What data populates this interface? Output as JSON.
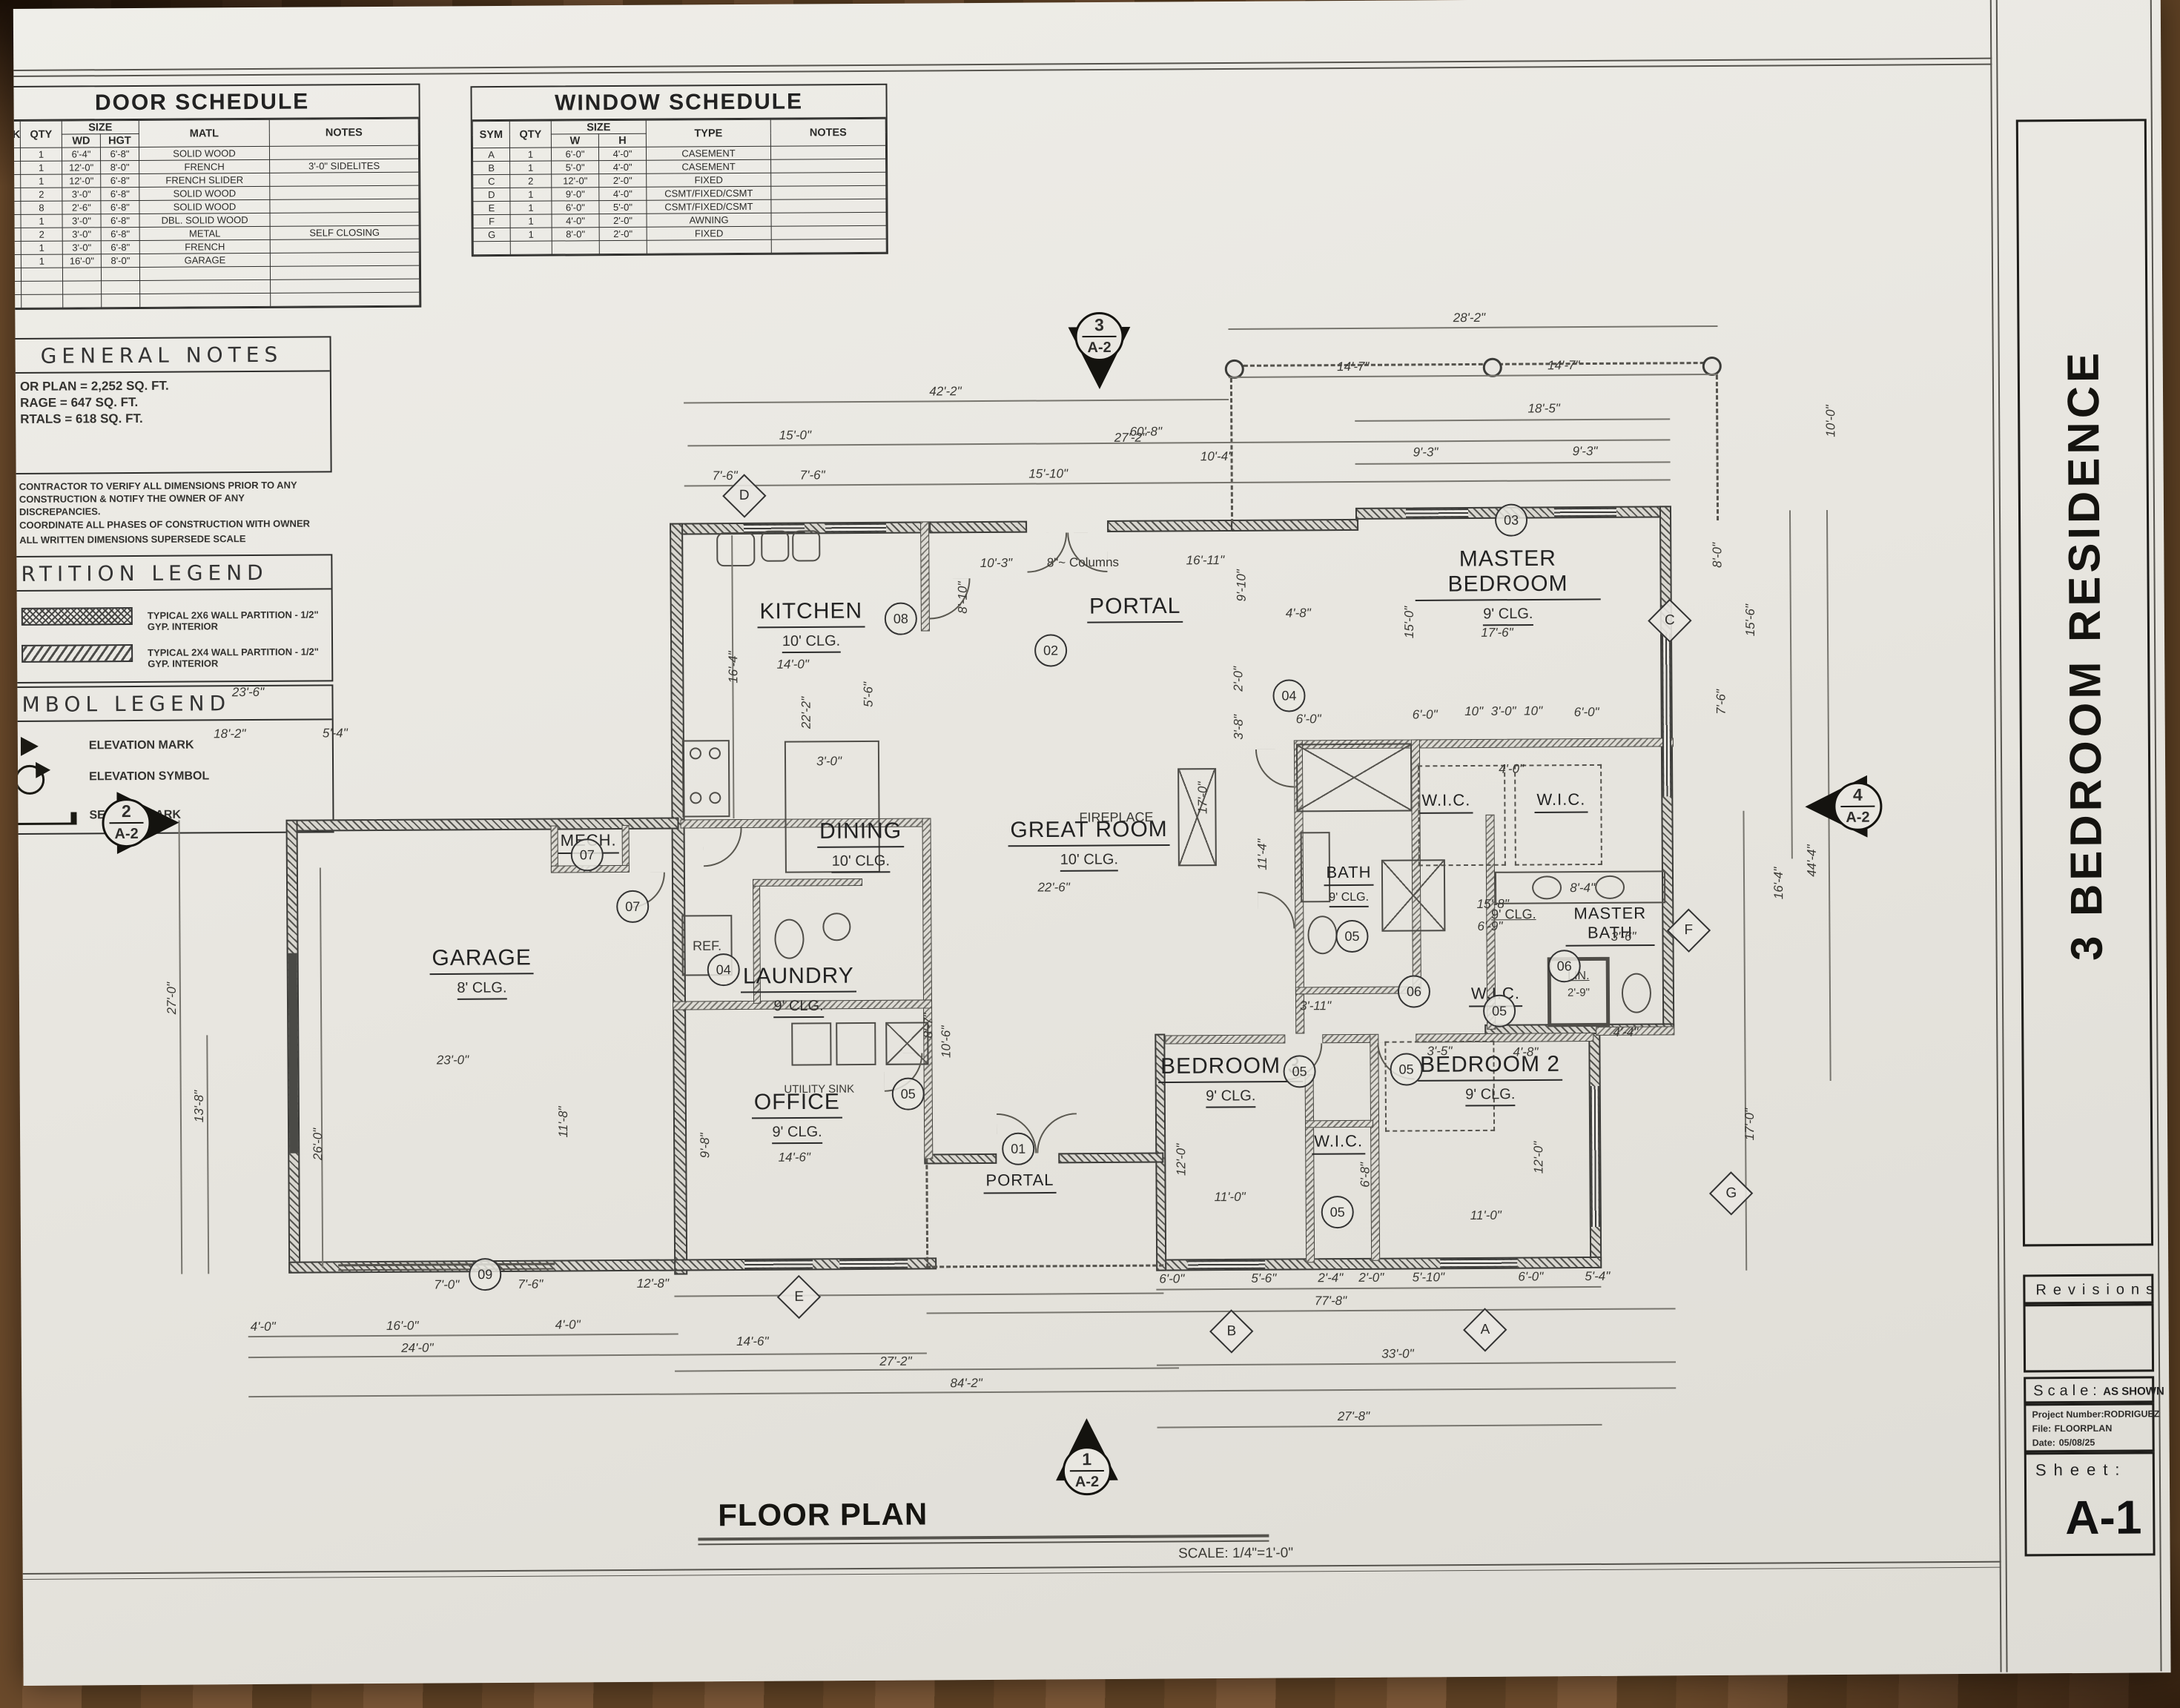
{
  "door_schedule": {
    "title": "DOOR SCHEDULE",
    "headers": {
      "mark": "MARK",
      "qty": "QTY",
      "size": "SIZE",
      "wd": "WD",
      "hgt": "HGT",
      "matl": "MATL",
      "notes": "NOTES"
    },
    "rows": [
      {
        "mark": "1",
        "qty": "1",
        "wd": "6'-4\"",
        "hgt": "6'-8\"",
        "matl": "SOLID WOOD",
        "notes": ""
      },
      {
        "mark": "2",
        "qty": "1",
        "wd": "12'-0\"",
        "hgt": "8'-0\"",
        "matl": "FRENCH",
        "notes": "3'-0\" SIDELITES"
      },
      {
        "mark": "3",
        "qty": "1",
        "wd": "12'-0\"",
        "hgt": "6'-8\"",
        "matl": "FRENCH SLIDER",
        "notes": ""
      },
      {
        "mark": "4",
        "qty": "2",
        "wd": "3'-0\"",
        "hgt": "6'-8\"",
        "matl": "SOLID WOOD",
        "notes": ""
      },
      {
        "mark": "5",
        "qty": "8",
        "wd": "2'-6\"",
        "hgt": "6'-8\"",
        "matl": "SOLID WOOD",
        "notes": ""
      },
      {
        "mark": "6",
        "qty": "1",
        "wd": "3'-0\"",
        "hgt": "6'-8\"",
        "matl": "DBL. SOLID WOOD",
        "notes": ""
      },
      {
        "mark": "7",
        "qty": "2",
        "wd": "3'-0\"",
        "hgt": "6'-8\"",
        "matl": "METAL",
        "notes": "SELF CLOSING"
      },
      {
        "mark": "8",
        "qty": "1",
        "wd": "3'-0\"",
        "hgt": "6'-8\"",
        "matl": "FRENCH",
        "notes": ""
      },
      {
        "mark": "9",
        "qty": "1",
        "wd": "16'-0\"",
        "hgt": "8'-0\"",
        "matl": "GARAGE",
        "notes": ""
      }
    ]
  },
  "window_schedule": {
    "title": "WINDOW  SCHEDULE",
    "headers": {
      "sym": "SYM",
      "qty": "QTY",
      "size": "SIZE",
      "w": "W",
      "h": "H",
      "type": "TYPE",
      "notes": "NOTES"
    },
    "rows": [
      {
        "sym": "A",
        "qty": "1",
        "w": "6'-0\"",
        "h": "4'-0\"",
        "type": "CASEMENT",
        "notes": ""
      },
      {
        "sym": "B",
        "qty": "1",
        "w": "5'-0\"",
        "h": "4'-0\"",
        "type": "CASEMENT",
        "notes": ""
      },
      {
        "sym": "C",
        "qty": "2",
        "w": "12'-0\"",
        "h": "2'-0\"",
        "type": "FIXED",
        "notes": ""
      },
      {
        "sym": "D",
        "qty": "1",
        "w": "9'-0\"",
        "h": "4'-0\"",
        "type": "CSMT/FIXED/CSMT",
        "notes": ""
      },
      {
        "sym": "E",
        "qty": "1",
        "w": "6'-0\"",
        "h": "5'-0\"",
        "type": "CSMT/FIXED/CSMT",
        "notes": ""
      },
      {
        "sym": "F",
        "qty": "1",
        "w": "4'-0\"",
        "h": "2'-0\"",
        "type": "AWNING",
        "notes": ""
      },
      {
        "sym": "G",
        "qty": "1",
        "w": "8'-0\"",
        "h": "2'-0\"",
        "type": "FIXED",
        "notes": ""
      }
    ]
  },
  "general_notes": {
    "title": "GENERAL  NOTES",
    "area_lines": [
      "OR PLAN  = 2,252 SQ. FT.",
      "RAGE  = 647 SQ. FT.",
      "RTALS  = 618 SQ. FT."
    ],
    "notes": [
      "CONTRACTOR TO VERIFY ALL DIMENSIONS PRIOR TO ANY",
      "CONSTRUCTION & NOTIFY THE OWNER OF ANY",
      "DISCREPANCIES.",
      "COORDINATE ALL PHASES OF CONSTRUCTION WITH OWNER",
      "ALL WRITTEN DIMENSIONS SUPERSEDE SCALE"
    ]
  },
  "partition_legend": {
    "title": "RTITION  LEGEND",
    "items": [
      "TYPICAL 2X6 WALL PARTITION -  1/2\" GYP. INTERIOR",
      "TYPICAL 2X4 WALL PARTITION - 1/2\" GYP.  INTERIOR"
    ]
  },
  "symbol_legend": {
    "title": "MBOL  LEGEND",
    "items": [
      "ELEVATION MARK",
      "ELEVATION SYMBOL",
      "SECTION MARK"
    ]
  },
  "title_block": {
    "project_title": "3 BEDROOM RESIDENCE",
    "revisions_label": "Revisions",
    "scale_label": "Scale:",
    "scale_value": "AS SHOWN",
    "project_number_label": "Project  Number:",
    "project_number": "RODRIGUEZ",
    "file_label": "File:",
    "file_value": "FLOORPLAN",
    "date_label": "Date:",
    "date_value": "05/08/25",
    "sheet_label": "Sheet:",
    "sheet_number": "A-1"
  },
  "plan": {
    "title": "FLOOR PLAN",
    "scale_note": "SCALE:  1/4\"=1'-0\"",
    "labels": {
      "fireplace": "FIREPLACE",
      "ref": "REF.",
      "utility_sink": "UTILITY SINK",
      "columns": "8\"~ Columns",
      "lin": "LIN.",
      "lin_dim": "2'-9\"",
      "hall_clg": "9' CLG."
    },
    "rooms": [
      {
        "name": "KITCHEN",
        "clg": "10' CLG."
      },
      {
        "name": "DINING",
        "clg": "10' CLG."
      },
      {
        "name": "GREAT ROOM",
        "clg": "10' CLG."
      },
      {
        "name": "PORTAL"
      },
      {
        "name": "MASTER BEDROOM",
        "clg": "9' CLG."
      },
      {
        "name": "GARAGE",
        "clg": "8' CLG."
      },
      {
        "name": "LAUNDRY",
        "clg": "9' CLG."
      },
      {
        "name": "OFFICE",
        "clg": "9' CLG."
      },
      {
        "name": "PORTAL"
      },
      {
        "name": "BEDROOM 3",
        "clg": "9' CLG."
      },
      {
        "name": "BEDROOM 2",
        "clg": "9' CLG."
      },
      {
        "name": "MASTER BATH"
      },
      {
        "name": "BATH",
        "clg": "9' CLG."
      },
      {
        "name": "MECH."
      },
      {
        "name": "W.I.C."
      },
      {
        "name": "W.I.C."
      },
      {
        "name": "W.I.C."
      },
      {
        "name": "W.I.C."
      }
    ],
    "door_markers": [
      "02",
      "03",
      "08",
      "04",
      "07",
      "07",
      "04",
      "05",
      "05",
      "05",
      "05",
      "05",
      "05",
      "06",
      "06",
      "01",
      "09"
    ],
    "window_markers": [
      "D",
      "C",
      "F",
      "G",
      "E",
      "B",
      "A"
    ],
    "elevation_markers": [
      {
        "num": "3",
        "sheet": "A-2"
      },
      {
        "num": "2",
        "sheet": "A-2"
      },
      {
        "num": "4",
        "sheet": "A-2"
      },
      {
        "num": "1",
        "sheet": "A-2"
      }
    ]
  },
  "dims": [
    "28'-2\"",
    "14'-7\"",
    "14'-7\"",
    "42'-2\"",
    "60'-8\"",
    "18'-5\"",
    "15'-0\"",
    "27'-2\"",
    "9'-3\"",
    "9'-3\"",
    "7'-6\"",
    "7'-6\"",
    "15'-10\"",
    "10'-4\"",
    "10'-0\"",
    "10'-3\"",
    "16'-11\"",
    "9'-10\"",
    "4'-8\"",
    "8'-10\"",
    "17'-6\"",
    "15'-0\"",
    "8'-0\"",
    "15'-6\"",
    "7'-6\"",
    "14'-0\"",
    "16'-4\"",
    "22'-2\"",
    "5'-6\"",
    "3'-0\"",
    "6'-0\"",
    "10\"",
    "3'-0\"",
    "10\"",
    "6'-0\"",
    "4'-0\"",
    "23'-6\"",
    "18'-2\"",
    "5'-4\"",
    "27'-0\"",
    "13'-8\"",
    "26'-0\"",
    "23'-0\"",
    "11'-8\"",
    "17'-0\"",
    "22'-6\"",
    "11'-4\"",
    "8'-4\"",
    "15'-8\"",
    "6'-9\"",
    "3'-6\"",
    "4'-4\"",
    "44'-4\"",
    "16'-4\"",
    "17'-0\"",
    "8'-7\"",
    "10'-6\"",
    "14'-6\"",
    "9'-8\"",
    "3'-11\"",
    "3'-5\"",
    "4'-8\"",
    "12'-0\"",
    "11'-0\"",
    "11'-0\"",
    "12'-0\"",
    "6'-8\"",
    "7'-0\"",
    "7'-6\"",
    "12'-8\"",
    "4'-0\"",
    "16'-0\"",
    "4'-0\"",
    "24'-0\"",
    "14'-6\"",
    "27'-2\"",
    "84'-2\"",
    "6'-0\"",
    "5'-6\"",
    "2'-4\"",
    "2'-0\"",
    "5'-10\"",
    "6'-0\"",
    "5'-4\"",
    "77'-8\"",
    "33'-0\"",
    "27'-8\"",
    "2'-0\"",
    "3'-8\"",
    "6'-0\""
  ]
}
